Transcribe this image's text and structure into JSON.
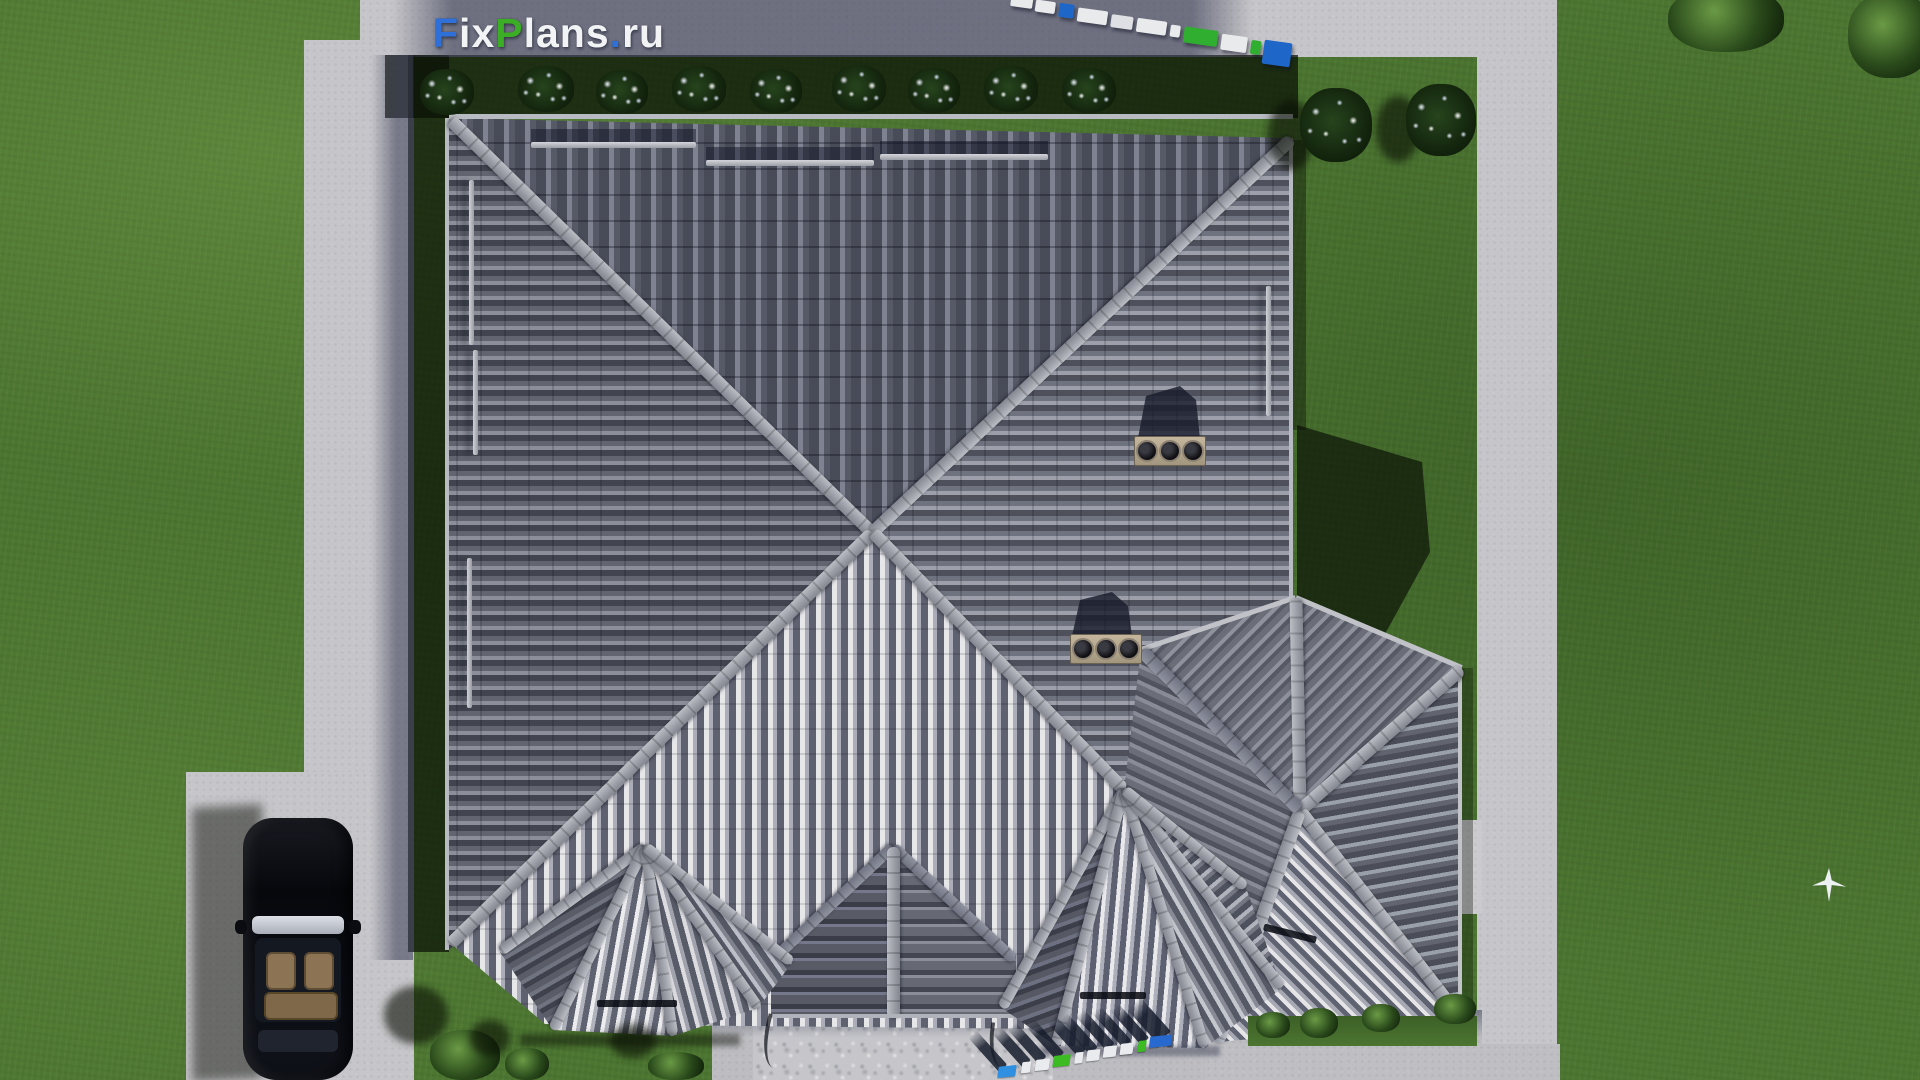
{
  "brand": {
    "full_text": "FixPlans.ru",
    "logo_segments": [
      {
        "text": "F",
        "color": "#2f6fd8"
      },
      {
        "text": "ix",
        "color": "#f2f3f5"
      },
      {
        "text": "P",
        "color": "#3cae25"
      },
      {
        "text": "lans",
        "color": "#f2f3f5"
      },
      {
        "text": ".",
        "color": "#2f6fd8"
      },
      {
        "text": "ru",
        "color": "#f2f3f5"
      }
    ]
  },
  "watermarks": {
    "top_right_label": "FixPlans.ru",
    "bottom_label": "FixPlans.ru"
  },
  "palette": {
    "lawn": "#4b7530",
    "lawn_shadow": "#15240e",
    "concrete": "#c6c5c9",
    "concrete_shadow": "#6d7287",
    "roof_north": "#565a66",
    "roof_west": "#7b7e89",
    "roof_east": "#8f929c",
    "roof_south": "#d6d7db",
    "ridge": "#a3a6ae",
    "chimney": "#b3a78e",
    "car_body": "#0b0d12",
    "car_interior": "#8c7354",
    "brand_blue": "#2f6fd8",
    "brand_green": "#3cae25"
  }
}
